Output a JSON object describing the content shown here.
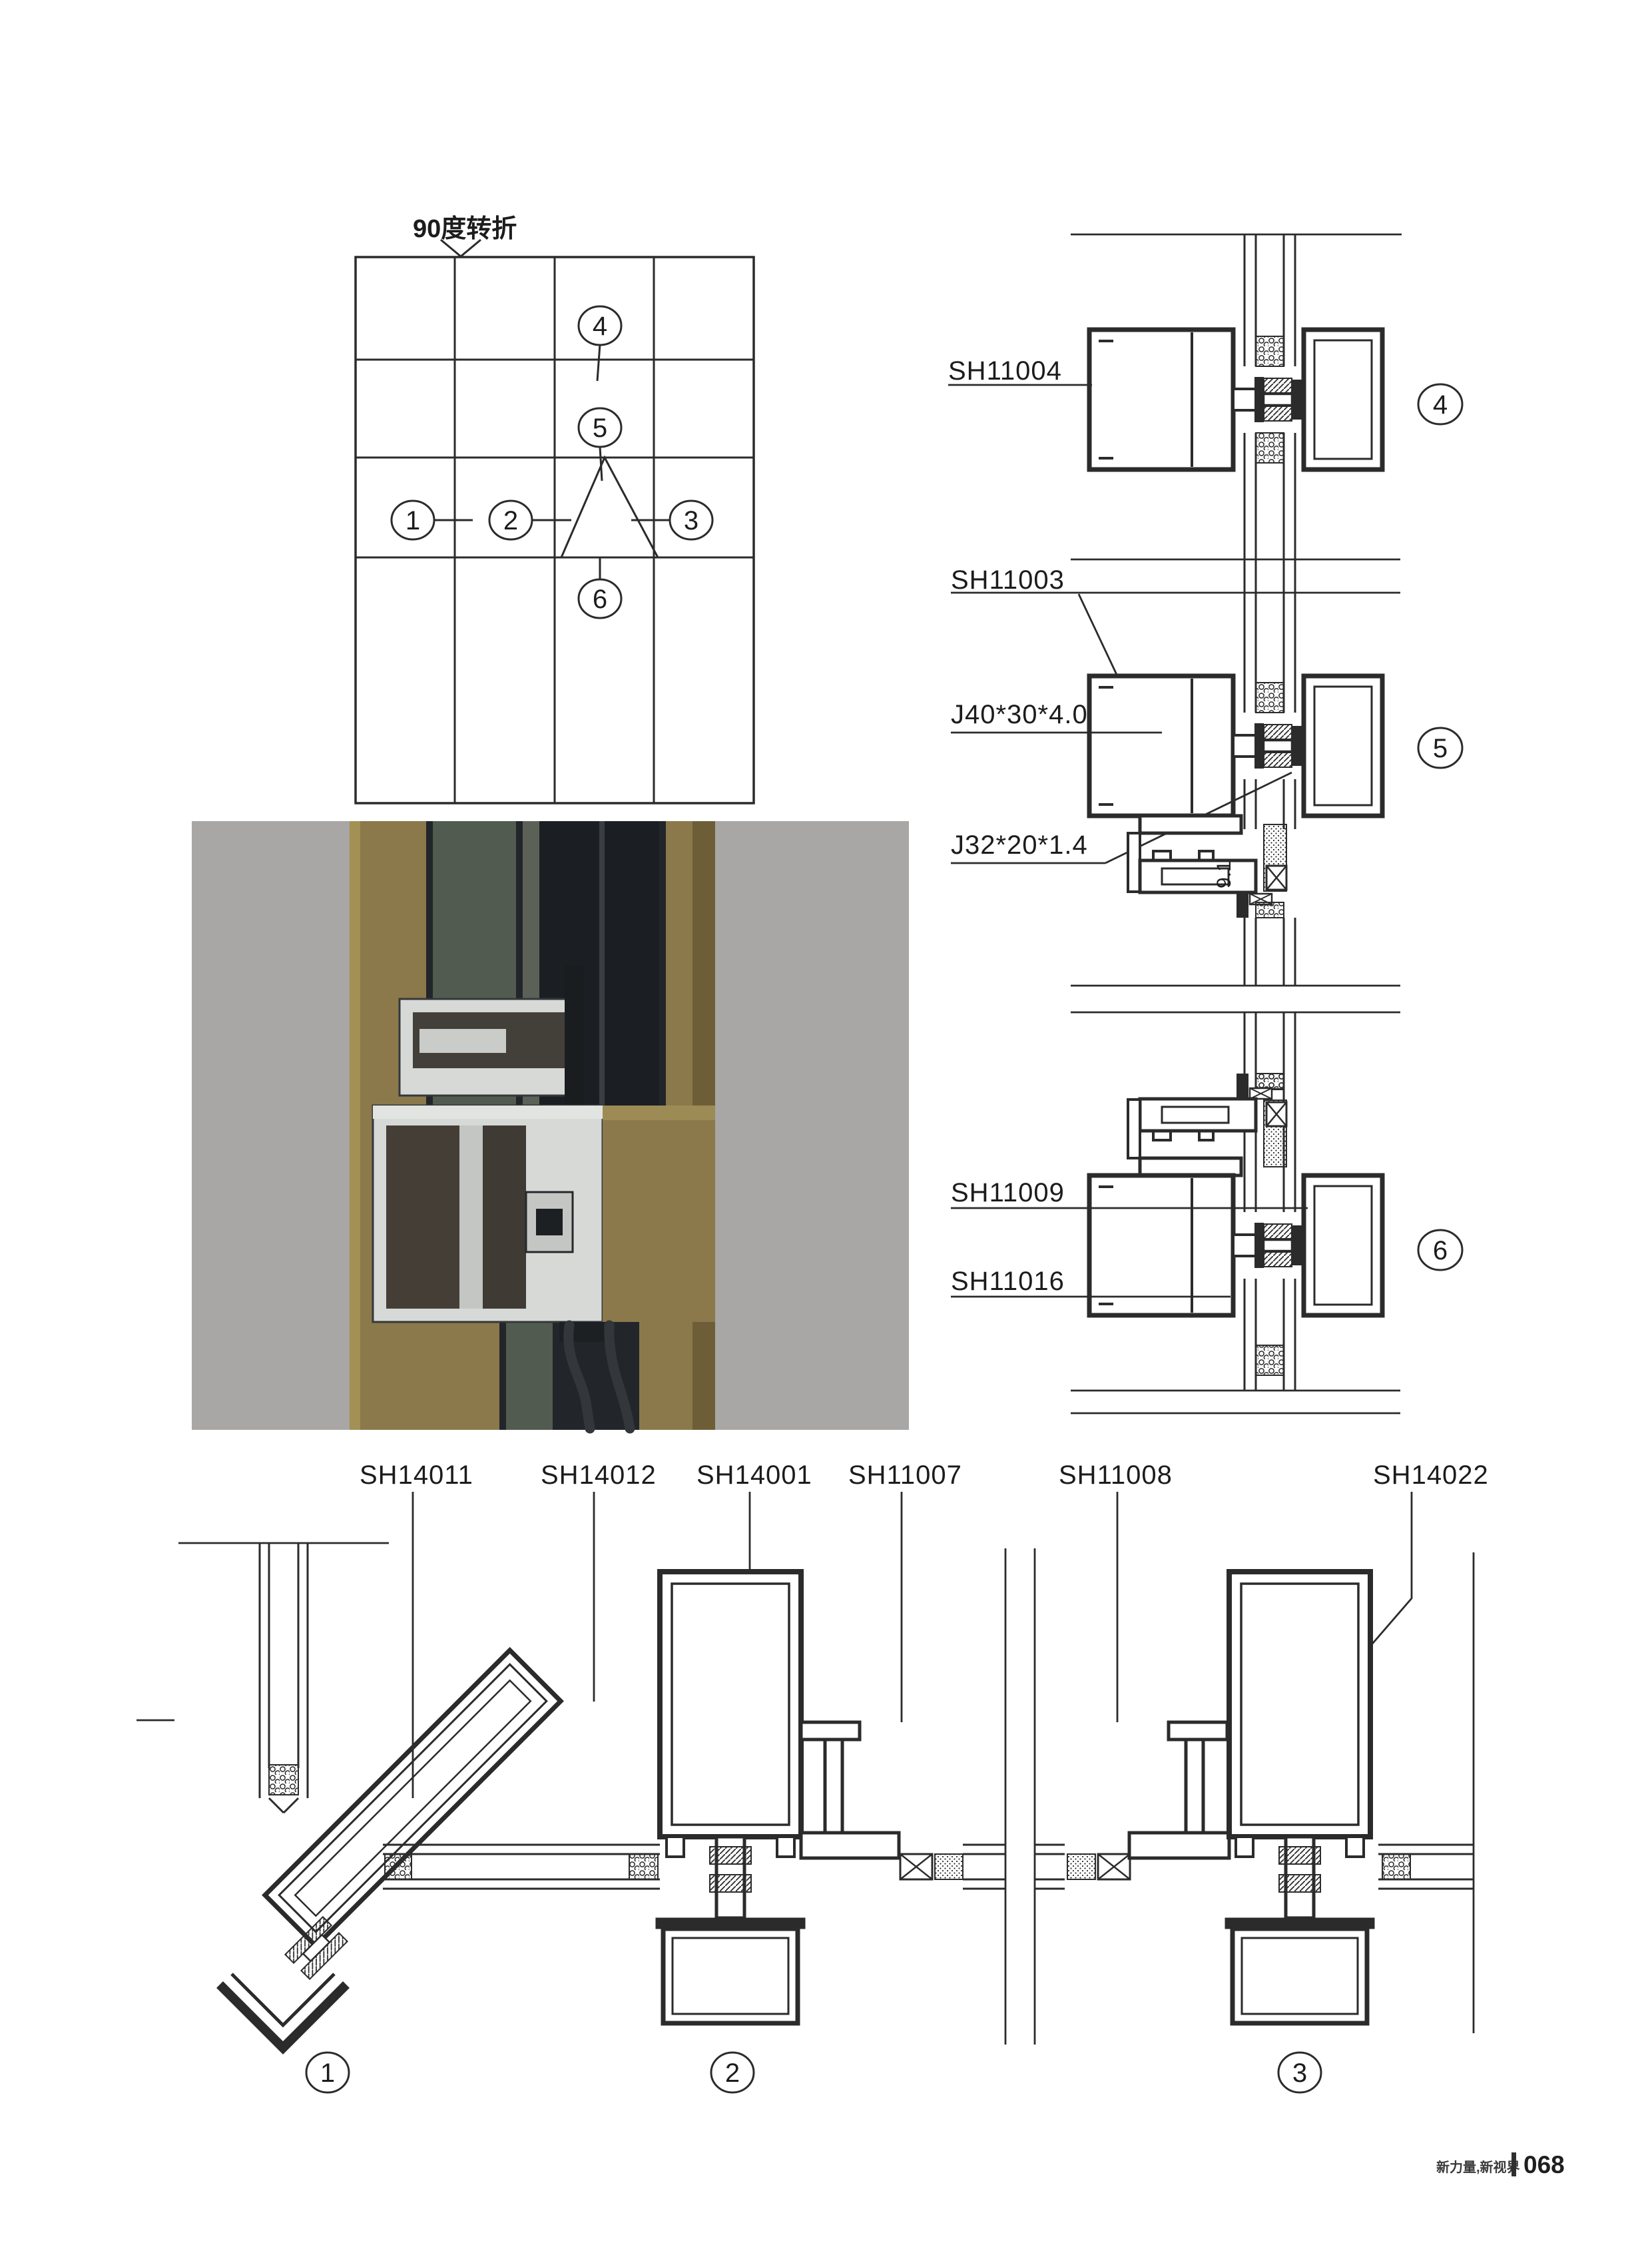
{
  "page": {
    "background": "#ffffff",
    "footer": {
      "slogan": "新力量,新视界",
      "page_number": "068"
    }
  },
  "colors": {
    "line": "#2b2b2b",
    "photo_background": "#a8a7a5",
    "photo_gold": "#8b794b",
    "photo_gold_dark": "#6e5e38",
    "photo_gold_light": "#a29055",
    "photo_frame_dark": "#1b1e22",
    "photo_glass_olive": "#515b4f",
    "photo_aluminum": "#d6d9d6"
  },
  "plan_diagram": {
    "note": "90度转折",
    "callouts": {
      "c1": "1",
      "c2": "2",
      "c3": "3",
      "c4": "4",
      "c5": "5",
      "c6": "6"
    }
  },
  "vertical_sections": {
    "d4": {
      "callout": "4",
      "label": "SH11004"
    },
    "d5": {
      "callout": "5",
      "label_profile": "SH11003",
      "label_steel": "J40*30*4.0",
      "label_angle": "J32*20*1.4",
      "dimension": "9.1"
    },
    "d6": {
      "callout": "6",
      "label_top": "SH11009",
      "label_bottom": "SH11016"
    }
  },
  "horizontal_sections": {
    "d1": {
      "callout": "1",
      "label_corner": "SH14011",
      "label_corner_mullion": "SH14012"
    },
    "d2": {
      "callout": "2",
      "label_mullion": "SH14001",
      "label_clip": "SH11007"
    },
    "d3": {
      "callout": "3",
      "label_clip": "SH11008",
      "label_mullion": "SH14022"
    }
  }
}
